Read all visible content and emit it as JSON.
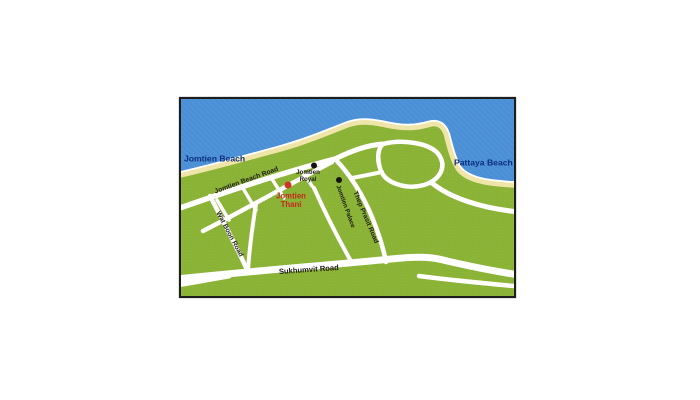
{
  "map": {
    "region_labels": {
      "jomtien_beach": "Jomtien Beach",
      "pattaya_beach": "Pattaya Beach"
    },
    "roads": {
      "jomtien_beach_road": "Jomtien Beach Road",
      "thep_prasit_road": "Thep Prasit Road",
      "wat_boon_road": "Wat Boon Road",
      "sukhumvit_road": "Sukhumvit Road"
    },
    "landmarks": {
      "jomtien_royal": {
        "line1": "Jomtien",
        "line2": "Royal"
      },
      "jomtien_thani": {
        "line1": "Jomtien",
        "line2": "Thani"
      },
      "jomtien_palace": "Jomtien Palace"
    },
    "colors": {
      "sea": "#4e92d8",
      "land": "#8cb437",
      "beach": "#f0e5a8",
      "waterline": "#ffffff",
      "road": "#ffffff",
      "frame": "#1d1d1b",
      "water_label": "#0c2f7c",
      "thani_label": "#c5261c",
      "marker_black": "#141414",
      "marker_red": "#cf3522"
    }
  }
}
